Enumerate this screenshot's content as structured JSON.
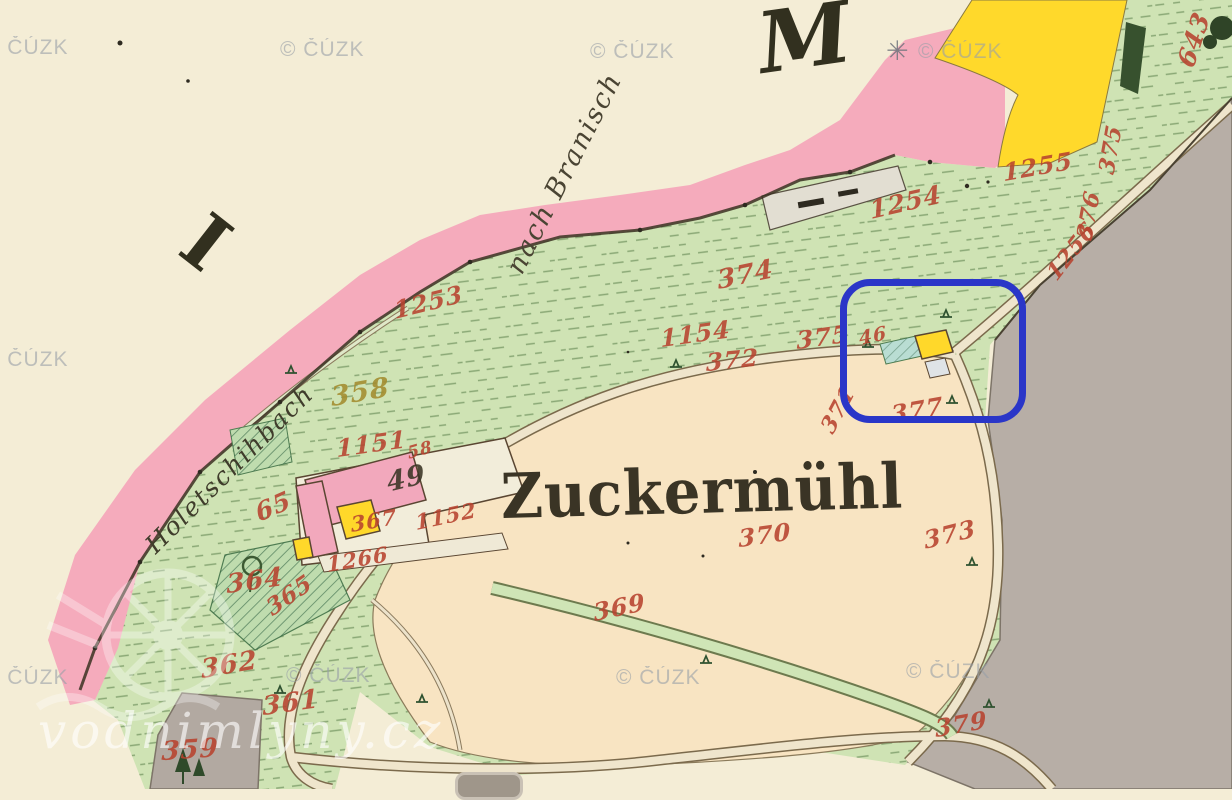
{
  "map": {
    "place_label": "Zuckermühl",
    "section_letters": {
      "left": "I",
      "right": "M"
    },
    "road_label": "nach Branisch",
    "stream_label": "Holetschihbach",
    "parcel_numbers": [
      {
        "t": "1253",
        "x": 392,
        "y": 296,
        "r": -14,
        "s": 24
      },
      {
        "t": "358",
        "x": 330,
        "y": 382,
        "r": -10,
        "s": 27,
        "c": "#a38c2e"
      },
      {
        "t": "1151",
        "x": 336,
        "y": 434,
        "r": -8,
        "s": 24
      },
      {
        "t": "65",
        "x": 252,
        "y": 500,
        "r": -24,
        "s": 25
      },
      {
        "t": "49",
        "x": 385,
        "y": 468,
        "r": -14,
        "s": 27,
        "c": "#3a3425"
      },
      {
        "t": "58",
        "x": 406,
        "y": 444,
        "r": -16,
        "s": 17
      },
      {
        "t": "367",
        "x": 350,
        "y": 512,
        "r": -10,
        "s": 21
      },
      {
        "t": "1152",
        "x": 414,
        "y": 510,
        "r": -12,
        "s": 21
      },
      {
        "t": "1266",
        "x": 326,
        "y": 552,
        "r": -10,
        "s": 21
      },
      {
        "t": "364",
        "x": 226,
        "y": 570,
        "r": -8,
        "s": 26
      },
      {
        "t": "365",
        "x": 262,
        "y": 598,
        "r": -35,
        "s": 23
      },
      {
        "t": "362",
        "x": 200,
        "y": 655,
        "r": -10,
        "s": 26
      },
      {
        "t": "361",
        "x": 262,
        "y": 692,
        "r": -8,
        "s": 26
      },
      {
        "t": "359",
        "x": 162,
        "y": 737,
        "r": -4,
        "s": 26
      },
      {
        "t": "369",
        "x": 592,
        "y": 598,
        "r": -12,
        "s": 24
      },
      {
        "t": "370",
        "x": 738,
        "y": 524,
        "r": -8,
        "s": 24
      },
      {
        "t": "371",
        "x": 816,
        "y": 424,
        "r": -62,
        "s": 22
      },
      {
        "t": "372",
        "x": 706,
        "y": 348,
        "r": -6,
        "s": 24
      },
      {
        "t": "374",
        "x": 716,
        "y": 266,
        "r": -12,
        "s": 26
      },
      {
        "t": "1154",
        "x": 660,
        "y": 324,
        "r": -8,
        "s": 24
      },
      {
        "t": "375",
        "x": 796,
        "y": 326,
        "r": -8,
        "s": 24
      },
      {
        "t": "46",
        "x": 858,
        "y": 328,
        "r": -12,
        "s": 19
      },
      {
        "t": "377",
        "x": 890,
        "y": 400,
        "r": -10,
        "s": 24
      },
      {
        "t": "373",
        "x": 922,
        "y": 526,
        "r": -14,
        "s": 24
      },
      {
        "t": "379",
        "x": 934,
        "y": 714,
        "r": -10,
        "s": 24
      },
      {
        "t": "1254",
        "x": 868,
        "y": 196,
        "r": -13,
        "s": 25
      },
      {
        "t": "1255",
        "x": 1002,
        "y": 158,
        "r": -10,
        "s": 24
      },
      {
        "t": "1256",
        "x": 1042,
        "y": 268,
        "r": -52,
        "s": 22
      },
      {
        "t": "643",
        "x": 1172,
        "y": 60,
        "r": -72,
        "s": 25
      },
      {
        "t": "375",
        "x": 1094,
        "y": 170,
        "r": -80,
        "s": 22
      },
      {
        "t": "376",
        "x": 1072,
        "y": 236,
        "r": -80,
        "s": 22
      }
    ],
    "watermarks": {
      "cuzk_text": "© ČÚZK",
      "cuzk_positions": [
        {
          "x": -16,
          "y": 36
        },
        {
          "x": 280,
          "y": 38
        },
        {
          "x": 590,
          "y": 40
        },
        {
          "x": 918,
          "y": 40
        },
        {
          "x": -16,
          "y": 348
        },
        {
          "x": -16,
          "y": 666
        },
        {
          "x": 286,
          "y": 664
        },
        {
          "x": 616,
          "y": 666
        },
        {
          "x": 906,
          "y": 660
        }
      ],
      "star_glyph": "✳",
      "site_text": "vodnimlyny.cz"
    }
  },
  "colors": {
    "parcel_red": "#b8432f",
    "paper_cream": "#f4edd6",
    "field_peach": "#f8e4c2",
    "meadow_green": "#cfe3b4",
    "built_pink": "#f5abbc",
    "wood_yellow": "#ffd82a",
    "neighbour_gray": "#b7aea6",
    "highlight_blue": "#2a36c8"
  }
}
